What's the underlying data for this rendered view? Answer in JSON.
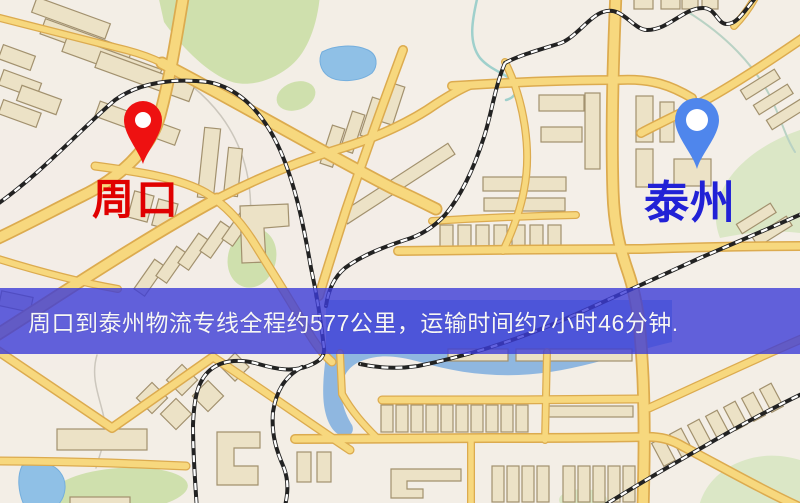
{
  "map": {
    "banner": {
      "text": "周口到泰州物流专线全程约577公里，运输时间约7小时46分钟.",
      "background_color": "#3c3cd7",
      "text_color": "#f7f7f5"
    },
    "markers": [
      {
        "id": "origin",
        "label": "周口",
        "pin_color": "#ee1111",
        "label_color": "#e00000"
      },
      {
        "id": "destination",
        "label": "泰州",
        "pin_color": "#4f86ec",
        "label_color": "#2121d6"
      }
    ],
    "route": {
      "from": "周口",
      "to": "泰州",
      "distance_km": "577",
      "duration": "7小时46分钟"
    },
    "palette": {
      "background": "#f3eee6",
      "road_fill": "#f7d87e",
      "road_casing": "#dcab4f",
      "water": "#8fc0e6",
      "park": "#cfe0ad",
      "building": "#ece2c6",
      "railway": "#222222"
    }
  }
}
